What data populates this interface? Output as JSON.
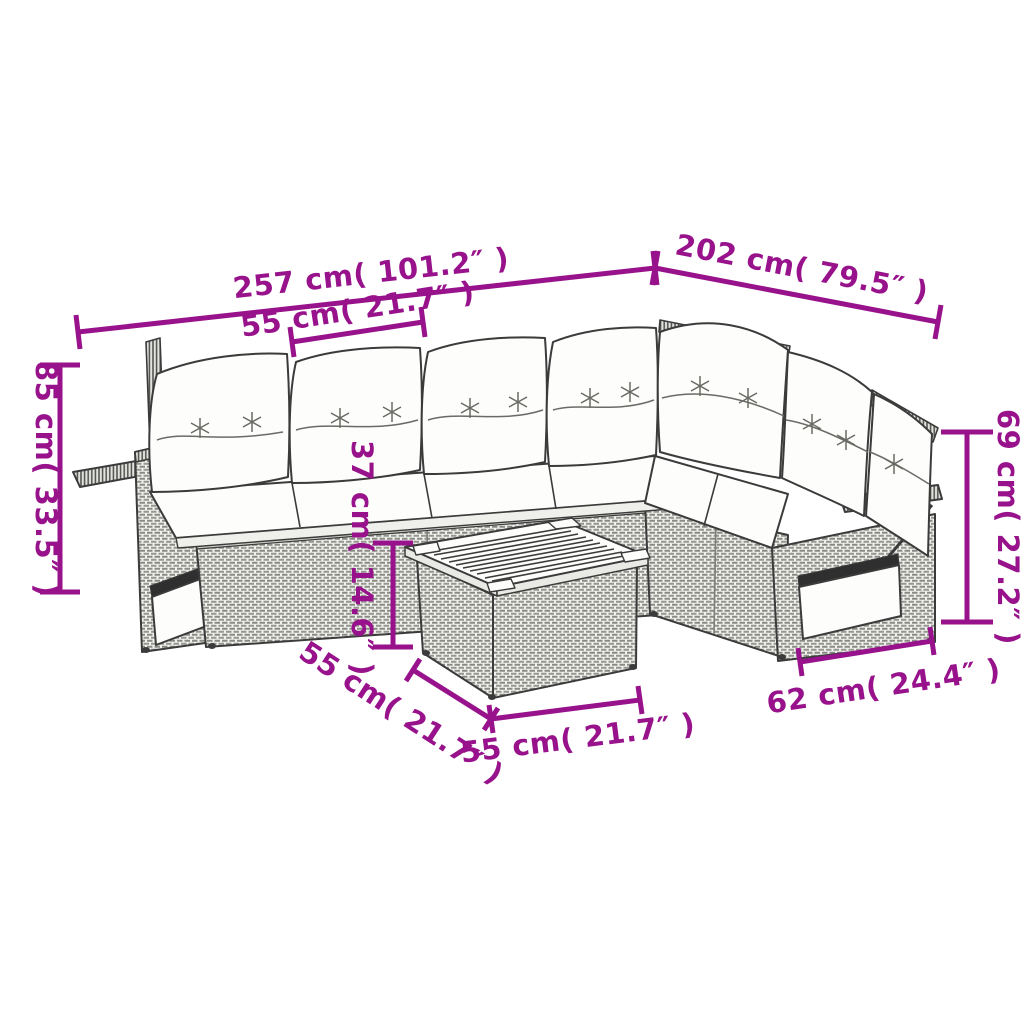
{
  "colors": {
    "dimension": "#97128B",
    "line_art": "#3b3b3b",
    "cushion_fill": "#fdfdfb",
    "wicker_fill": "#f1f1ef"
  },
  "dimensions": {
    "total_width": {
      "label": "257 cm( 101.2″ )"
    },
    "total_depth": {
      "label": "202 cm( 79.5″ )"
    },
    "seat_width": {
      "label": "55 cm( 21.7″ )"
    },
    "sofa_height": {
      "label": "85 cm( 33.5″ )"
    },
    "back_height": {
      "label": "69 cm( 27.2″ )"
    },
    "table_height": {
      "label": "37 cm( 14.6″ )"
    },
    "table_depth": {
      "label": "55 cm( 21.7″ )"
    },
    "table_width": {
      "label": "55 cm( 21.7″ )"
    },
    "arm_depth": {
      "label": "62 cm( 24.4″ )"
    }
  }
}
